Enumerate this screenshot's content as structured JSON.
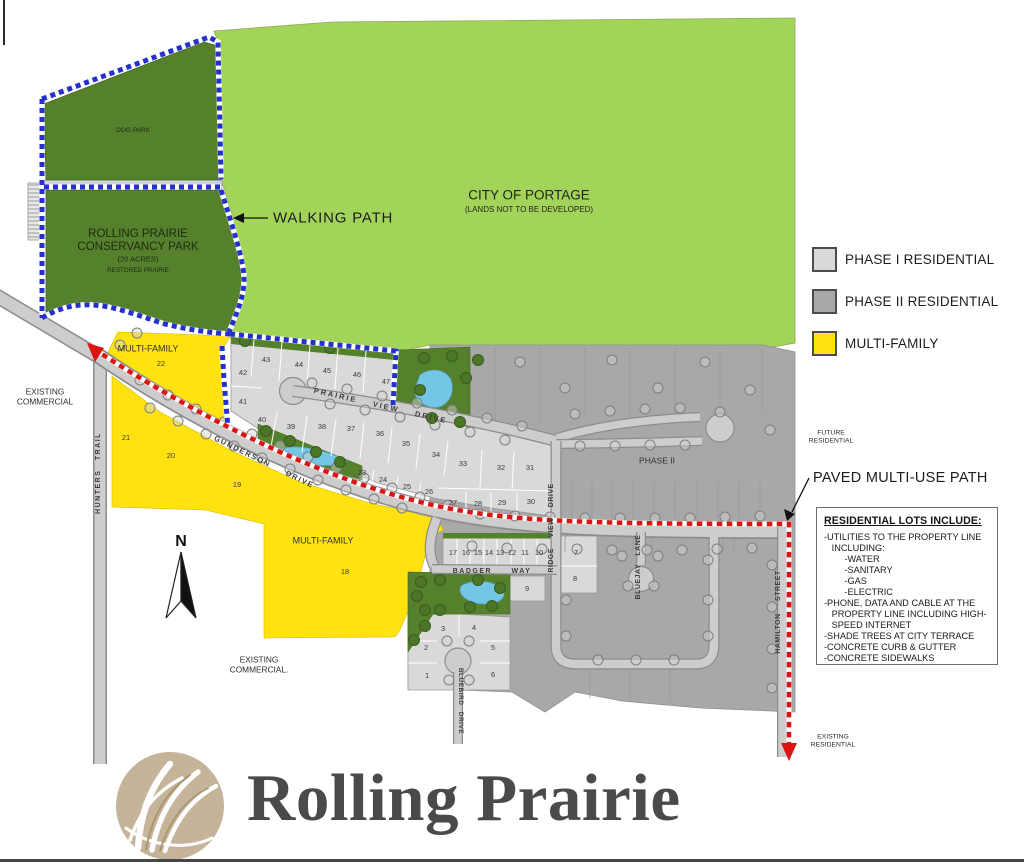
{
  "map": {
    "city_parcel": {
      "name": "CITY OF PORTAGE",
      "note": "(LANDS NOT TO BE DEVELOPED)"
    },
    "dog_park": {
      "label": "DOG PARK"
    },
    "conservancy": {
      "line1": "ROLLING PRAIRIE",
      "line2": "CONSERVANCY PARK",
      "line3": "(20 ACRES)",
      "line4": "RESTORED PRAIRIE"
    },
    "walking_path": {
      "label": "WALKING PATH"
    },
    "paved_path": {
      "label": "PAVED MULTI-USE PATH"
    },
    "north_arrow": {
      "label": "N"
    },
    "legend": {
      "items": [
        {
          "label": "PHASE I RESIDENTIAL",
          "color": "#d9d9d9"
        },
        {
          "label": "PHASE II RESIDENTIAL",
          "color": "#a8a8a8"
        },
        {
          "label": "MULTI-FAMILY",
          "color": "#ffe20f"
        }
      ]
    },
    "annotations": {
      "existing_commercial_nw": "EXISTING COMMERCIAL",
      "existing_commercial_s": "EXISTING COMMERCIAL.",
      "future_residential": "FUTURE RESIDENTIAL",
      "existing_residential": "EXISTING RESIDENTIAL",
      "phase2_area": "PHASE II",
      "multi_family_22": "MULTI-FAMILY",
      "multi_family_18": "MULTI-FAMILY"
    },
    "streets": {
      "hunters_trail": "HUNTERS TRAIL",
      "gunderson_drive": "GUNDERSON DRIVE",
      "prairie_view_drive": "PRAIRIE VIEW DRIVE",
      "badger_way": "BADGER WAY",
      "ridge_view_drive": "RIDGE VIEW DRIVE",
      "bluejay_lane": "BLUEJAY LANE",
      "bluebird_drive": "BLUEBIRD DRIVE",
      "hamilton_street": "HAMILTON STREET"
    },
    "lots": [
      {
        "n": "1",
        "x": 427,
        "y": 678
      },
      {
        "n": "2",
        "x": 426,
        "y": 650
      },
      {
        "n": "3",
        "x": 443,
        "y": 631
      },
      {
        "n": "4",
        "x": 474,
        "y": 630
      },
      {
        "n": "5",
        "x": 493,
        "y": 650
      },
      {
        "n": "6",
        "x": 493,
        "y": 677
      },
      {
        "n": "7",
        "x": 576,
        "y": 555
      },
      {
        "n": "8",
        "x": 575,
        "y": 581
      },
      {
        "n": "9",
        "x": 527,
        "y": 591
      },
      {
        "n": "10",
        "x": 539,
        "y": 555
      },
      {
        "n": "11",
        "x": 525,
        "y": 555
      },
      {
        "n": "12",
        "x": 512,
        "y": 555
      },
      {
        "n": "13",
        "x": 500,
        "y": 555
      },
      {
        "n": "14",
        "x": 489,
        "y": 555
      },
      {
        "n": "15",
        "x": 478,
        "y": 555
      },
      {
        "n": "16",
        "x": 466,
        "y": 555
      },
      {
        "n": "17",
        "x": 453,
        "y": 555
      },
      {
        "n": "18",
        "x": 345,
        "y": 574
      },
      {
        "n": "19",
        "x": 237,
        "y": 487
      },
      {
        "n": "20",
        "x": 171,
        "y": 458
      },
      {
        "n": "21",
        "x": 126,
        "y": 440
      },
      {
        "n": "22",
        "x": 161,
        "y": 366
      },
      {
        "n": "23",
        "x": 362,
        "y": 475
      },
      {
        "n": "24",
        "x": 383,
        "y": 482
      },
      {
        "n": "25",
        "x": 407,
        "y": 489
      },
      {
        "n": "26",
        "x": 429,
        "y": 494
      },
      {
        "n": "27",
        "x": 453,
        "y": 505
      },
      {
        "n": "28",
        "x": 478,
        "y": 506
      },
      {
        "n": "29",
        "x": 502,
        "y": 505
      },
      {
        "n": "30",
        "x": 531,
        "y": 504
      },
      {
        "n": "31",
        "x": 530,
        "y": 470
      },
      {
        "n": "32",
        "x": 501,
        "y": 470
      },
      {
        "n": "33",
        "x": 463,
        "y": 466
      },
      {
        "n": "34",
        "x": 436,
        "y": 457
      },
      {
        "n": "35",
        "x": 406,
        "y": 446
      },
      {
        "n": "36",
        "x": 380,
        "y": 436
      },
      {
        "n": "37",
        "x": 351,
        "y": 431
      },
      {
        "n": "38",
        "x": 322,
        "y": 429
      },
      {
        "n": "39",
        "x": 291,
        "y": 429
      },
      {
        "n": "40",
        "x": 262,
        "y": 422
      },
      {
        "n": "41",
        "x": 243,
        "y": 404
      },
      {
        "n": "42",
        "x": 243,
        "y": 375
      },
      {
        "n": "43",
        "x": 266,
        "y": 362
      },
      {
        "n": "44",
        "x": 299,
        "y": 367
      },
      {
        "n": "45",
        "x": 327,
        "y": 373
      },
      {
        "n": "46",
        "x": 357,
        "y": 377
      },
      {
        "n": "47",
        "x": 386,
        "y": 384
      }
    ],
    "residential_box": {
      "title": "RESIDENTIAL LOTS INCLUDE:",
      "lines": [
        "-UTILITIES TO THE PROPERTY LINE",
        "   INCLUDING:",
        "        -WATER",
        "        -SANITARY",
        "        -GAS",
        "        -ELECTRIC",
        "-PHONE, DATA AND CABLE AT THE",
        "   PROPERTY LINE INCLUDING HIGH-",
        "   SPEED INTERNET",
        "-SHADE TREES AT CITY TERRACE",
        "-CONCRETE CURB & GUTTER",
        "-CONCRETE SIDEWALKS"
      ]
    }
  },
  "logo": {
    "text": "Rolling Prairie"
  },
  "colors": {
    "light_green": "#a3d45a",
    "dark_green": "#55802c",
    "yellow": "#ffe20f",
    "phase1_gray": "#d9d9d9",
    "phase2_gray": "#a8a8a8",
    "road_gray": "#cdcdcd",
    "road_edge": "#8d8d8d",
    "pond_blue": "#74c6e6",
    "path_red": "#dc1414",
    "path_blue": "#2431cd",
    "logo_tan": "#c5b499"
  }
}
